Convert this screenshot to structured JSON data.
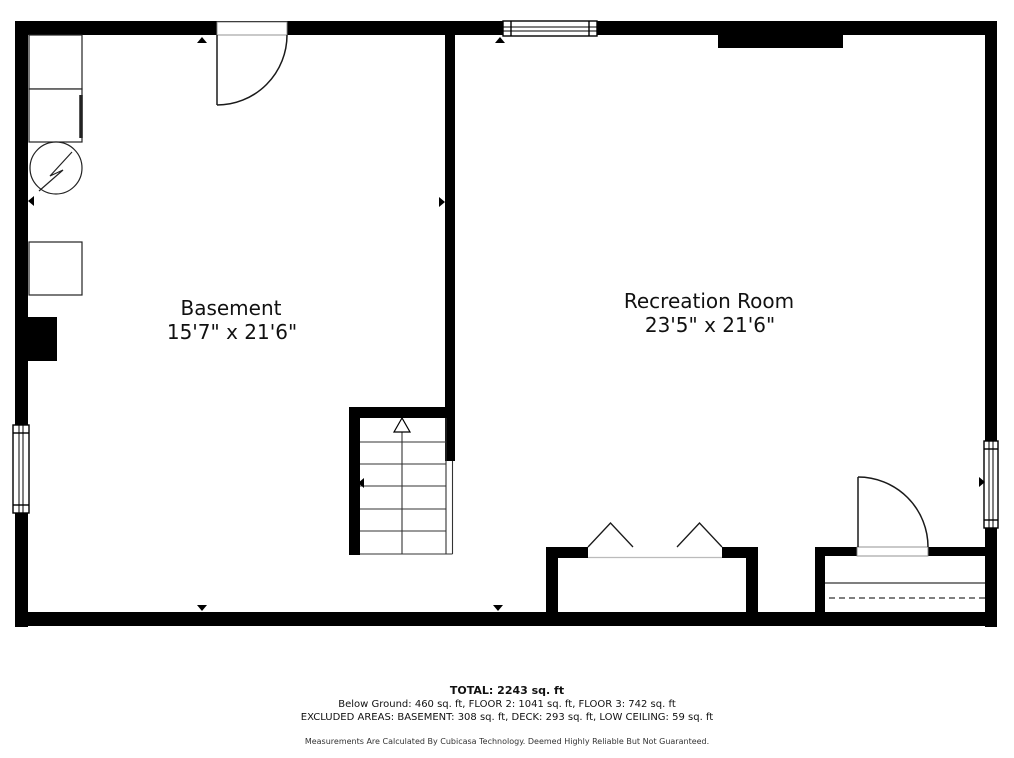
{
  "colors": {
    "wall": "#000000",
    "background": "#ffffff",
    "line": "#1a1a1a",
    "threshold": "#bbbbbb"
  },
  "rooms": [
    {
      "name": "Basement",
      "dimensions": "15'7\" x 21'6\""
    },
    {
      "name": "Recreation Room",
      "dimensions": "23'5\" x 21'6\""
    }
  ],
  "symbols": {
    "door_swing": "quarter-arc door swing",
    "window": "double-line window",
    "staircase_up": "stairs with up arrow",
    "water_heater": "circle with lightning bolt",
    "double_door": "chevron double-door",
    "chimney": "solid black block",
    "measure_arrow": "small solid triangle"
  },
  "footer": {
    "total": "TOTAL: 2243 sq. ft",
    "floors": "Below Ground: 460 sq. ft, FLOOR 2: 1041 sq. ft, FLOOR 3: 742 sq. ft",
    "excluded": "EXCLUDED AREAS: BASEMENT: 308 sq. ft, DECK: 293 sq. ft, LOW CEILING: 59 sq. ft",
    "disclaimer": "Measurements Are Calculated By Cubicasa Technology. Deemed Highly Reliable But Not Guaranteed."
  }
}
